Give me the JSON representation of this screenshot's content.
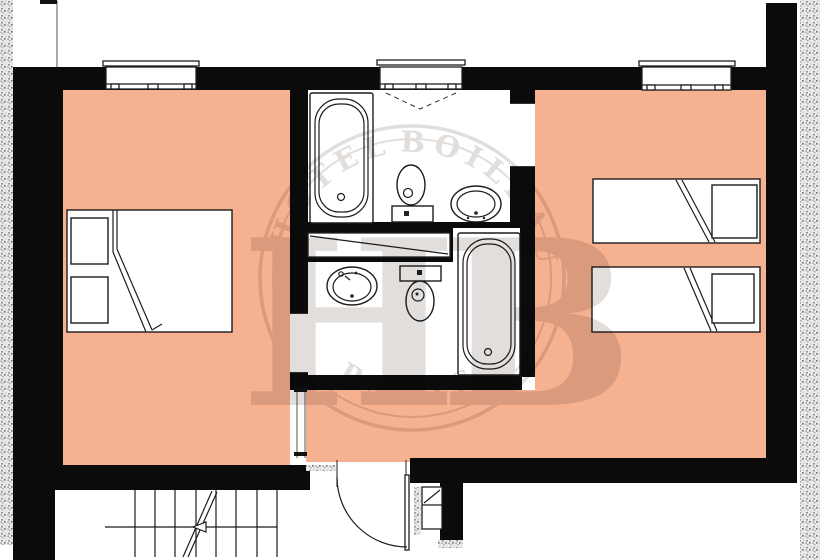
{
  "watermark": {
    "hotel_name_left": "HOTEL",
    "hotel_name_right": "BOILEAU",
    "city": "PARIS",
    "monogram": "HB"
  },
  "colors": {
    "room_fill": "#f6b191",
    "wall": "#0b0b0b",
    "fixture_line": "#1c1c1c",
    "masonry_speckle": "#a8a8a8",
    "watermark": "#8d7f78",
    "background": "#ffffff"
  },
  "floorplan": {
    "rooms": [
      "bedroom-left",
      "bedroom-right",
      "bathroom-top",
      "bathroom-bottom",
      "hallway",
      "stair-hall"
    ],
    "fixtures": {
      "bedroom_left": [
        "double-bed",
        "nightstand",
        "nightstand"
      ],
      "bedroom_right": [
        "single-bed",
        "nightstand",
        "single-bed",
        "nightstand"
      ],
      "bathroom_top": [
        "bathtub",
        "toilet",
        "sink"
      ],
      "bathroom_bottom": [
        "sink",
        "toilet",
        "bathtub"
      ],
      "circulation": [
        "staircase",
        "entrance-door",
        "duct-shaft",
        "linen-closet"
      ]
    },
    "window_count": 3
  }
}
